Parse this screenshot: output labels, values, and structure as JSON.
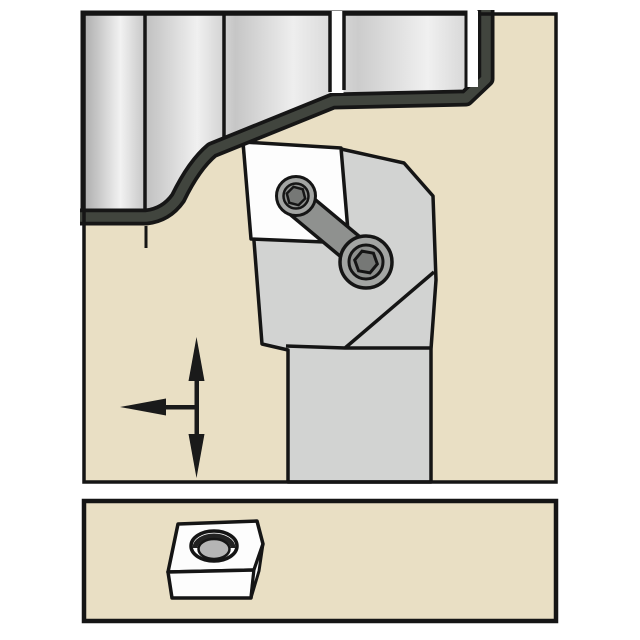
{
  "figure": {
    "type": "tool-application-diagram",
    "upper_panel": "turning-tool-holder-machining-stepped-workpiece",
    "lower_panel": "indexable-insert-3d-view"
  },
  "colors": {
    "background": "#ffffff",
    "panel_fill": "#e9dfc4",
    "outline": "#151515",
    "machined_surface": "#41453e",
    "holder_body": "#d2d3d2",
    "insert": "#fdfdfd",
    "clamp": "#8f918f",
    "screw_outer": "#a3a5a3",
    "screw_inner": "#8d8f8d",
    "hex_socket": "#767876",
    "hole": "#b5b5b5",
    "arrow": "#1a1a1a",
    "workpiece_edge_dark": "#b0b0b0",
    "workpiece_highlight": "#f4f4f4"
  },
  "icons": {
    "vertical_feed_arrow": "double-headed-vertical-arrow",
    "horizontal_feed_arrow": "left-pointing-arrow"
  }
}
